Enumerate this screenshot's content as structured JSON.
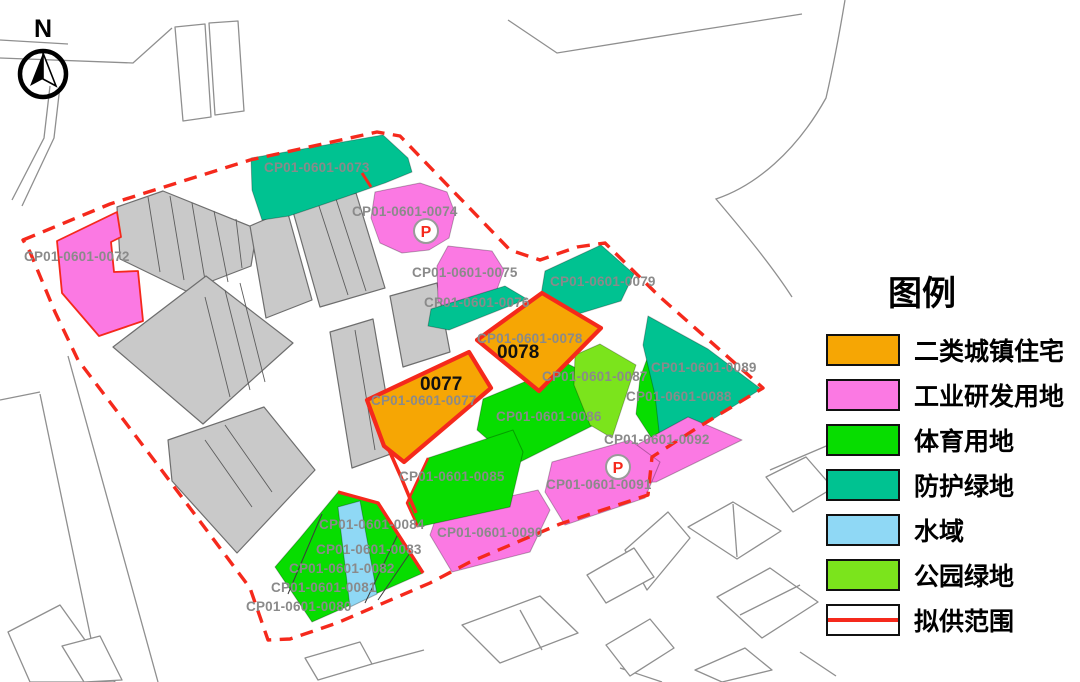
{
  "colors": {
    "orange": "#F6A604",
    "pink": "#FB79E3",
    "green": "#07DD00",
    "teal": "#00C291",
    "water": "#8FD8F5",
    "lime": "#7BE41C",
    "red": "#F5291C",
    "grayfill": "#C9C9C9",
    "grayedge": "#6E6E6E",
    "road": "#8F8F8F",
    "label": "#8A8A8A"
  },
  "north": {
    "label": "N"
  },
  "parking": {
    "label": "P"
  },
  "legend": {
    "title": "图例",
    "items": [
      {
        "label": "二类城镇住宅",
        "color_key": "orange"
      },
      {
        "label": "工业研发用地",
        "color_key": "pink"
      },
      {
        "label": "体育用地",
        "color_key": "green"
      },
      {
        "label": "防护绿地",
        "color_key": "teal"
      },
      {
        "label": "水域",
        "color_key": "water"
      },
      {
        "label": "公园绿地",
        "color_key": "lime"
      },
      {
        "label": "拟供范围",
        "color_key": "scope-red-outline"
      }
    ]
  },
  "highlights": {
    "h0077": "0077",
    "h0078": "0078"
  },
  "parcels": {
    "p0072": {
      "code": "CP01-0601-0072"
    },
    "p0073": {
      "code": "CP01-0601-0073"
    },
    "p0074": {
      "code": "CP01-0601-0074"
    },
    "p0075": {
      "code": "CP01-0601-0075"
    },
    "p0076": {
      "code": "CP01-0601-0076"
    },
    "p0077": {
      "code": "CP01-0601-0077"
    },
    "p0078": {
      "code": "CP01-0601-0078"
    },
    "p0079": {
      "code": "CP01-0601-0079"
    },
    "p0080": {
      "code": "CP01-0601-0080"
    },
    "p0081": {
      "code": "CP01-0601-0081"
    },
    "p0082": {
      "code": "CP01-0601-0082"
    },
    "p0083": {
      "code": "CP01-0601-0083"
    },
    "p0084": {
      "code": "CP01-0601-0084"
    },
    "p0085": {
      "code": "CP01-0601-0085"
    },
    "p0086": {
      "code": "CP01-0601-0086"
    },
    "p0087": {
      "code": "CP01-0601-0087"
    },
    "p0088": {
      "code": "CP01-0601-0088"
    },
    "p0089": {
      "code": "CP01-0601-0089"
    },
    "p0090": {
      "code": "CP01-0601-0090"
    },
    "p0091": {
      "code": "CP01-0601-0091"
    },
    "p0092": {
      "code": "CP01-0601-0092"
    }
  }
}
